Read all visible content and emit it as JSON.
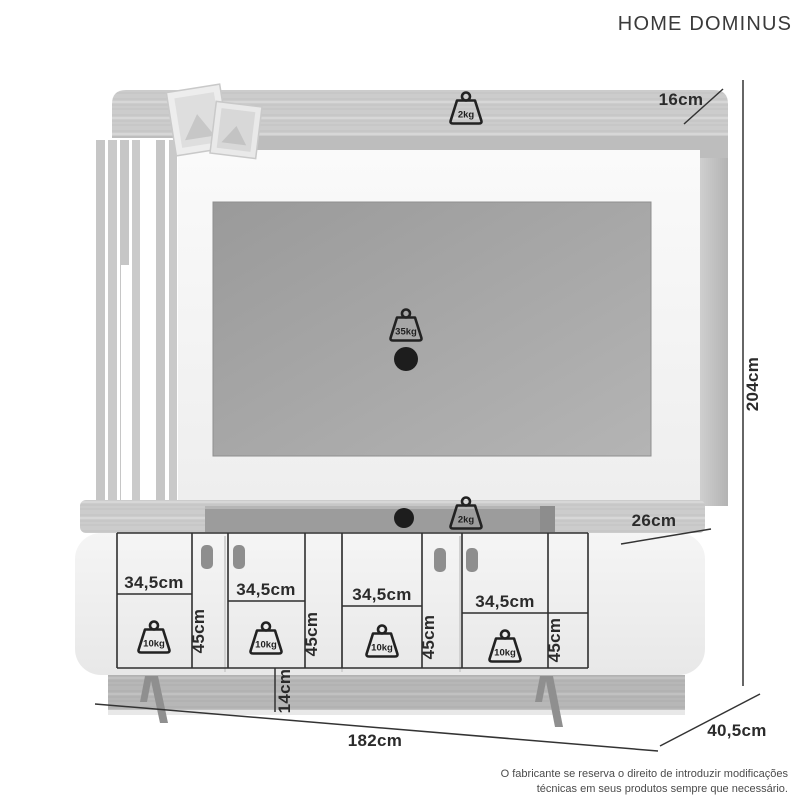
{
  "title": "HOME DOMINUS",
  "product": {
    "overall": {
      "height": "204cm",
      "width": "182cm",
      "depth": "40,5cm",
      "top_panel_depth": "16cm",
      "lower_shelf_depth": "26cm",
      "base_height": "14cm"
    },
    "load_capacity": {
      "top_panel": "2kg",
      "tv_panel": "35kg",
      "lower_shelf": "2kg"
    },
    "doors": [
      {
        "width": "34,5cm",
        "height": "45cm",
        "load": "10kg"
      },
      {
        "width": "34,5cm",
        "height": "45cm",
        "load": "10kg"
      },
      {
        "width": "34,5cm",
        "height": "45cm",
        "load": "10kg"
      },
      {
        "width": "34,5cm",
        "height": "45cm",
        "load": "10kg"
      }
    ]
  },
  "footer": {
    "disclaimer_line1": "O fabricante se reserva o direito de introduzir modificações",
    "disclaimer_line2": "técnicas em seus produtos sempre que necessário."
  },
  "colors": {
    "line": "#333333",
    "text": "#2e2e2e",
    "wood_light": "#cbcbcb",
    "panel_white": "#f7f7f7",
    "tv_screen": "#a8a8a8"
  }
}
